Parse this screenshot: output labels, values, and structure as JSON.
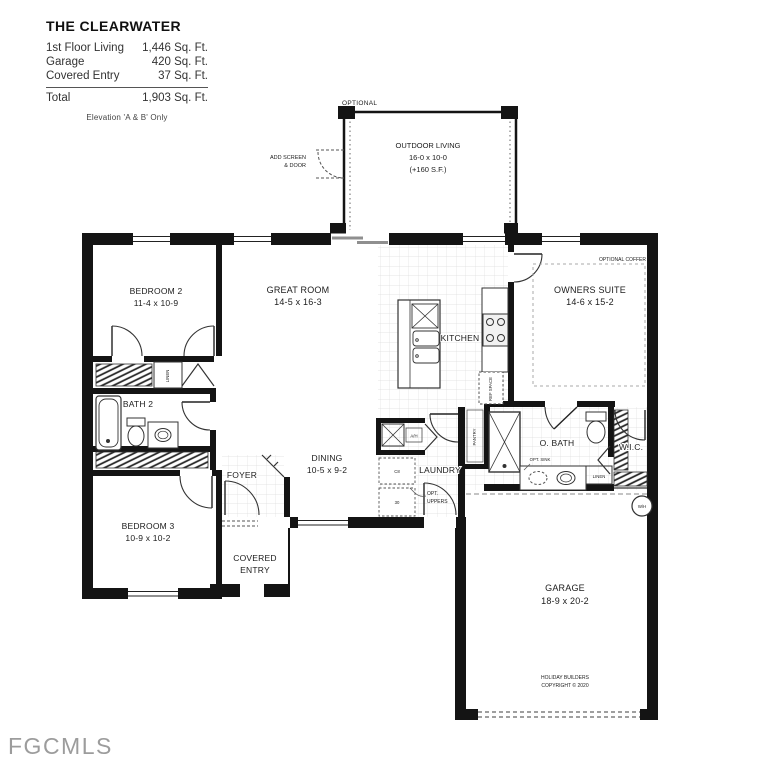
{
  "watermark": "FGCMLS",
  "colors": {
    "wall": "#141414",
    "text": "#1c1c1c",
    "watermark": "#9c9c9c",
    "tile_grid": "#dedede"
  },
  "title_block": {
    "title": "THE CLEARWATER",
    "rows": [
      {
        "label": "1st Floor Living",
        "value": "1,446 Sq. Ft."
      },
      {
        "label": "Garage",
        "value": "420 Sq. Ft."
      },
      {
        "label": "Covered Entry",
        "value": "37 Sq. Ft."
      }
    ],
    "total": {
      "label": "Total",
      "value": "1,903 Sq. Ft."
    },
    "note": "Elevation 'A & B' Only"
  },
  "rooms": {
    "outdoor_living": {
      "name": "OUTDOOR LIVING",
      "dims": "16-0 x 10-0",
      "extra": "(+160 S.F.)"
    },
    "bedroom2": {
      "name": "BEDROOM 2",
      "dims": "11-4 x 10-9"
    },
    "great_room": {
      "name": "GREAT ROOM",
      "dims": "14-5 x 16-3"
    },
    "kitchen": {
      "name": "KITCHEN"
    },
    "owners_suite": {
      "name": "OWNERS SUITE",
      "dims": "14-6 x 15-2"
    },
    "bath2": {
      "name": "BATH 2"
    },
    "dining": {
      "name": "DINING",
      "dims": "10-5 x 9-2"
    },
    "laundry": {
      "name": "LAUNDRY"
    },
    "obath": {
      "name": "O. BATH"
    },
    "wic": {
      "name": "W.I.C."
    },
    "foyer": {
      "name": "FOYER"
    },
    "bedroom3": {
      "name": "BEDROOM 3",
      "dims": "10-9 x 10-2"
    },
    "covered_entry": {
      "line1": "COVERED",
      "line2": "ENTRY"
    },
    "garage": {
      "name": "GARAGE",
      "dims": "18-9 x 20-2"
    }
  },
  "annotations": {
    "optional": "OPTIONAL",
    "add_screen_line1": "ADD SCREEN",
    "add_screen_line2": "& DOOR",
    "optional_coffer": "OPTIONAL COFFER",
    "opt_sink": "OPT. SINK",
    "opt_uppers_line1": "OPT.",
    "opt_uppers_line2": "UPPERS",
    "ref_space": "REF SPACE",
    "pantry": "PANTRY",
    "linen_hall": "LINEN",
    "linen_bath": "LINEN",
    "air_handler": "A/H",
    "water_heater": "W/H",
    "cabinet1": "C8",
    "cabinet2": "30",
    "copyright_line1": "HOLIDAY BUILDERS",
    "copyright_line2": "COPYRIGHT © 2020"
  }
}
